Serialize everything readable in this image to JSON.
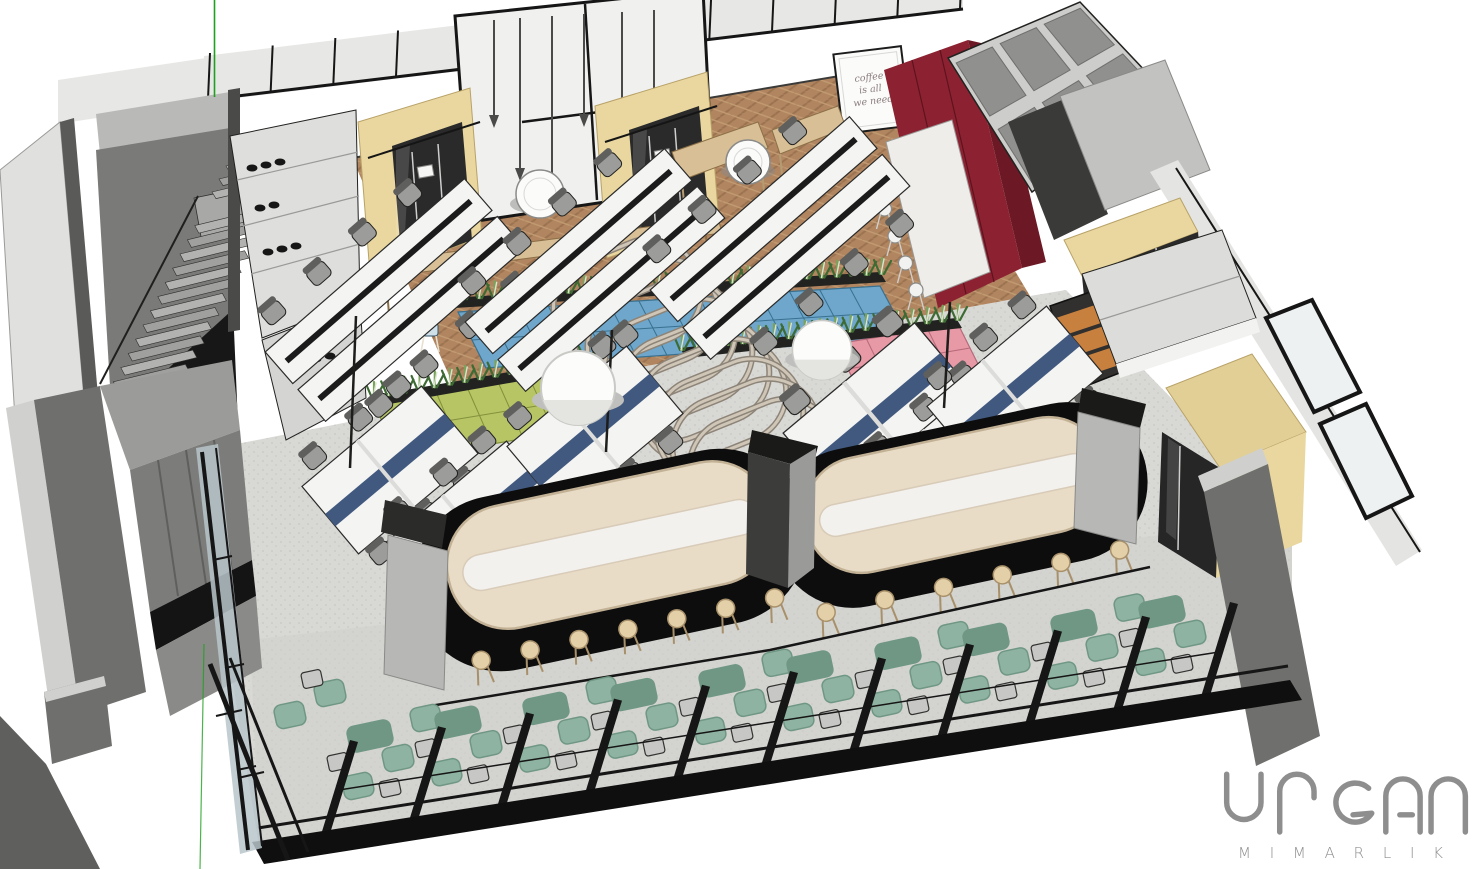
{
  "title": "3D office interior rendering (axonometric cutaway)",
  "logo": {
    "name": "URGAN",
    "subtitle": "M I M A R L I K"
  },
  "poster": {
    "line1": "coffee",
    "line2": "is all",
    "line3": "we need"
  },
  "scene": {
    "view": "isometric cutaway of open-plan office floor",
    "desk_rows_wood": 3,
    "desk_pods": 6,
    "phone_booths": 4,
    "arches": 9,
    "lounge_partitions": 11,
    "banquettes": 2,
    "banquette_stools_left": 7,
    "banquette_stools_right": 6,
    "kitchen_stools": 5,
    "pendant_lamps": 6,
    "stair_steps": 13,
    "dome_lights": 2,
    "round_tables": 2,
    "planter_rows": 3,
    "locker_colors": [
      "blue",
      "green",
      "pink"
    ],
    "features": [
      "herringbone wood floor",
      "phone booths",
      "plant dividers on lockers",
      "arched metal hoops",
      "cream banquette high tables",
      "teal lounge nooks",
      "glazed black-frame facade",
      "switchback staircase",
      "burgundy kitchen wall"
    ]
  },
  "palette": {
    "bg": "#ffffff",
    "wallLight": "#e7e7e5",
    "wallMid": "#b9b9b7",
    "wallDark": "#6e6e6c",
    "wallDarker": "#4c4c4a",
    "frame": "#161616",
    "glassTint": "#eef1f1",
    "facadeGlass": "#b9c6cb",
    "wood1": "#b08560",
    "wood2": "#9c7350",
    "wood3": "#c29b72",
    "floorGray": "#d8d8d5",
    "floorDot": "#c2c2bf",
    "carpet": "#cfcfcc",
    "deskWhite": "#f4f4f2",
    "deskEdge": "#2a2a2a",
    "tray": "#1b1b1b",
    "dividerBlue": "#41597f",
    "chair": "#9c9c9a",
    "chairDark": "#5f5f5d",
    "lockerBlue": "#6ea7cb",
    "lockerBlueLine": "#39708f",
    "lockerGreen": "#b7c565",
    "lockerGreenLine": "#83913b",
    "lockerPink": "#e899a6",
    "lockerPinkLine": "#b5697a",
    "plant1": "#3d6b33",
    "plant2": "#79a35b",
    "plant3": "#d9e4cb",
    "trough": "#222220",
    "boothYellow": "#e9d79f",
    "boothYellowDark": "#d9c285",
    "boothDoor": "#2a2a2a",
    "redCab": "#8c2231",
    "redCabDark": "#6d1825",
    "cream": "#e8dcc6",
    "creamEdge": "#c2b195",
    "tableTop": "#f3f1ed",
    "rug": "#0d0d0d",
    "teal": "#8fb3a2",
    "tealDark": "#6f9784",
    "sideTable": "#c7c7c5",
    "stool": "#e3cfa8",
    "stoolLine": "#a8916a",
    "concrete": "#b7b7b5",
    "columnDark": "#343432",
    "columnCap": "#1a1a18",
    "arch1": "#8d8478",
    "arch2": "#cfc6b8",
    "benchWood": "#d8bf95",
    "orange": "#c8803e",
    "island": "#efede9",
    "cubby": "#cdcdcb",
    "cubbyDark": "#90908e",
    "axis": "#1fa11f",
    "logo": "#8e8e8e",
    "poster": "#8a7d7d"
  }
}
